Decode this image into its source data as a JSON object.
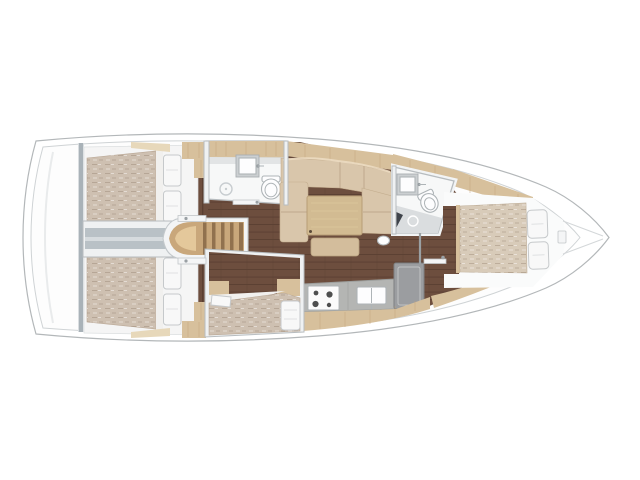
{
  "meta": {
    "title": "Sailing yacht interior layout plan (top view, bow to the right)",
    "view": "overhead floor plan",
    "canvas": {
      "width": 640,
      "height": 480
    }
  },
  "palette": {
    "background": "#ffffff",
    "hull_fill": "#ffffff",
    "hull_line": "#b3b7b9",
    "inner_fill": "#fdfdfd",
    "inner_line": "#cfd3d5",
    "wall_fill": "#eff1f2",
    "wall_line": "#b7bcbf",
    "bulkhead": "#a9b2b8",
    "divider": "#b9c1c6",
    "divider_hi": "#d6dbde",
    "floor_wood": "#6d4e3e",
    "floor_line": "#5a3f31",
    "cabinet_wood": "#d7c09c",
    "cabinet_wood_light": "#e7d8ba",
    "cabinet_grain": "#c2a47c",
    "mattress": "#cec0b1",
    "mattress_fwd": "#d8cbb9",
    "pillow": "#f8f8f8",
    "pillow_line": "#c6c9cb",
    "sofa": "#d9c6ab",
    "sofa_seam": "#b6a084",
    "table_wood": "#d2bb92",
    "ottoman": "#d3bd9c",
    "bathroom_floor": "#f7f8f8",
    "shower_floor": "#dadddf",
    "white_fixture": "#fdfdfe",
    "fixture_line": "#aeb4b7",
    "counter": "#b4b5b3",
    "counter_line": "#9b9d9b",
    "appliance": "#9b9da0",
    "appliance_line": "#7e8082",
    "steps_wood": "#c9a77b",
    "steps_hi": "#ecd3a6",
    "steps_gap": "#8b6c49",
    "stern_shade": "#e9ebec",
    "bow_line": "#d4d7d9",
    "burner": "#4e4f4f"
  },
  "inventory": {
    "orientation": {
      "bow": "right",
      "stern": "left"
    },
    "rooms": [
      {
        "id": "aft-cabin-starboard",
        "name": "Aft double cabin (top)",
        "features": [
          "double bed",
          "two pillows",
          "wardrobe",
          "head shelf"
        ]
      },
      {
        "id": "aft-cabin-port",
        "name": "Aft double cabin (bottom)",
        "features": [
          "double bed",
          "two pillows",
          "wardrobe",
          "head shelf"
        ]
      },
      {
        "id": "engine-compartment",
        "name": "Engine box between aft cabins",
        "features": []
      },
      {
        "id": "companionway",
        "name": "Companionway steps",
        "features": [
          "4 treads"
        ]
      },
      {
        "id": "head-aft",
        "name": "Aft head (bathroom, top)",
        "features": [
          "vanity cabinet",
          "sink",
          "toilet",
          "shower drain"
        ]
      },
      {
        "id": "saloon",
        "name": "Saloon",
        "features": [
          "L-shaped sofa",
          "dining table",
          "ottoman"
        ]
      },
      {
        "id": "galley",
        "name": "Galley (bottom)",
        "features": [
          "stove with 4 burners",
          "sink",
          "refrigerator",
          "cabinet front"
        ]
      },
      {
        "id": "midship-berth-cabin",
        "name": "Midship berth compartment (bottom)",
        "features": [
          "berth",
          "pillow",
          "lockers",
          "cushion"
        ]
      },
      {
        "id": "head-forward",
        "name": "Forward head (bathroom)",
        "features": [
          "sink",
          "toilet",
          "shower floor",
          "drain"
        ]
      },
      {
        "id": "forward-cabin",
        "name": "Forward cabin",
        "features": [
          "island double bed",
          "two pillows",
          "side shelves"
        ]
      }
    ]
  }
}
